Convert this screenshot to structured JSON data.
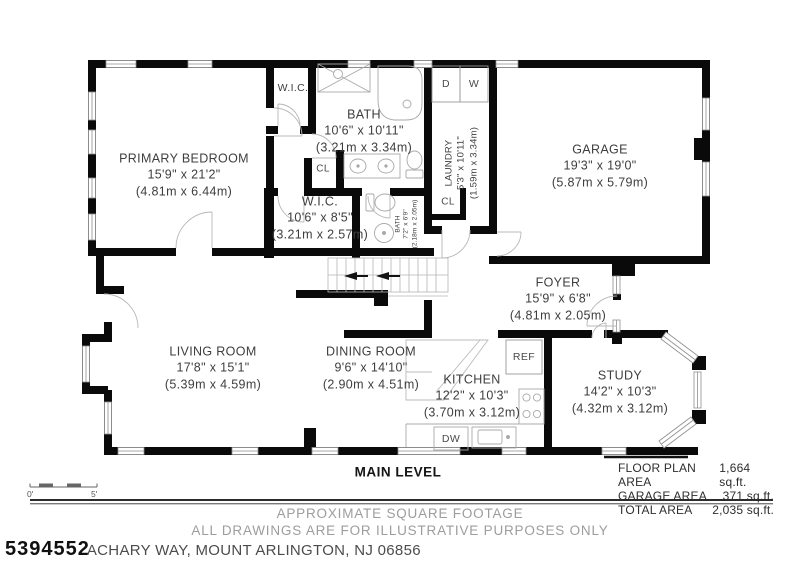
{
  "colors": {
    "wall": "#0a0a0a",
    "fixture_line": "#a8a8a8",
    "label_text": "#3e3e3e",
    "muted_text": "#9d9d9d"
  },
  "plan": {
    "level_label": "MAIN LEVEL",
    "rooms": {
      "primary_bedroom": {
        "name": "PRIMARY BEDROOM",
        "imperial": "15'9\" x 21'2\"",
        "metric": "(4.81m x 6.44m)"
      },
      "wic_top": {
        "name": "W.I.C."
      },
      "bath_main": {
        "name": "BATH",
        "imperial": "10'6\" x 10'11\"",
        "metric": "(3.21m x 3.34m)"
      },
      "laundry": {
        "name": "LAUNDRY",
        "imperial": "5'3\" x 10'11\"",
        "metric": "(1.59m x 3.34m)"
      },
      "garage": {
        "name": "GARAGE",
        "imperial": "19'3\" x 19'0\"",
        "metric": "(5.87m x 5.79m)"
      },
      "wic_mid": {
        "name": "W.I.C.",
        "imperial": "10'6\" x 8'5\"",
        "metric": "(3.21m x 2.57m)"
      },
      "bath_small": {
        "name": "BATH",
        "imperial": "7'2\" x 6'9\"",
        "metric": "(2.18m x 2.05m)"
      },
      "foyer": {
        "name": "FOYER",
        "imperial": "15'9\" x 6'8\"",
        "metric": "(4.81m x 2.05m)"
      },
      "living": {
        "name": "LIVING ROOM",
        "imperial": "17'8\" x 15'1\"",
        "metric": "(5.39m x 4.59m)"
      },
      "dining": {
        "name": "DINING ROOM",
        "imperial": "9'6\" x 14'10\"",
        "metric": "(2.90m x 4.51m)"
      },
      "kitchen": {
        "name": "KITCHEN",
        "imperial": "12'2\" x 10'3\"",
        "metric": "(3.70m x 3.12m)"
      },
      "study": {
        "name": "STUDY",
        "imperial": "14'2\" x 10'3\"",
        "metric": "(4.32m x 3.12m)"
      }
    },
    "closets": {
      "cl1": "CL",
      "cl2": "CL"
    },
    "appliances": {
      "dryer": "D",
      "washer": "W",
      "fridge": "REF",
      "dishwasher": "DW"
    },
    "scale": {
      "start": "0'",
      "end": "5'"
    }
  },
  "areas": {
    "rows": [
      {
        "label": "FLOOR PLAN AREA",
        "value": "1,664 sq.ft."
      },
      {
        "label": "GARAGE AREA",
        "value": "371 sq.ft."
      },
      {
        "label": "TOTAL AREA",
        "value": "2,035 sq.ft."
      }
    ]
  },
  "footer": {
    "disclaimer_line1": "APPROXIMATE SQUARE FOOTAGE",
    "disclaimer_line2": "ALL DRAWINGS ARE FOR ILLUSTRATIVE PURPOSES ONLY",
    "listing_number": "5394552",
    "address": "ACHARY WAY, MOUNT ARLINGTON, NJ 06856"
  }
}
